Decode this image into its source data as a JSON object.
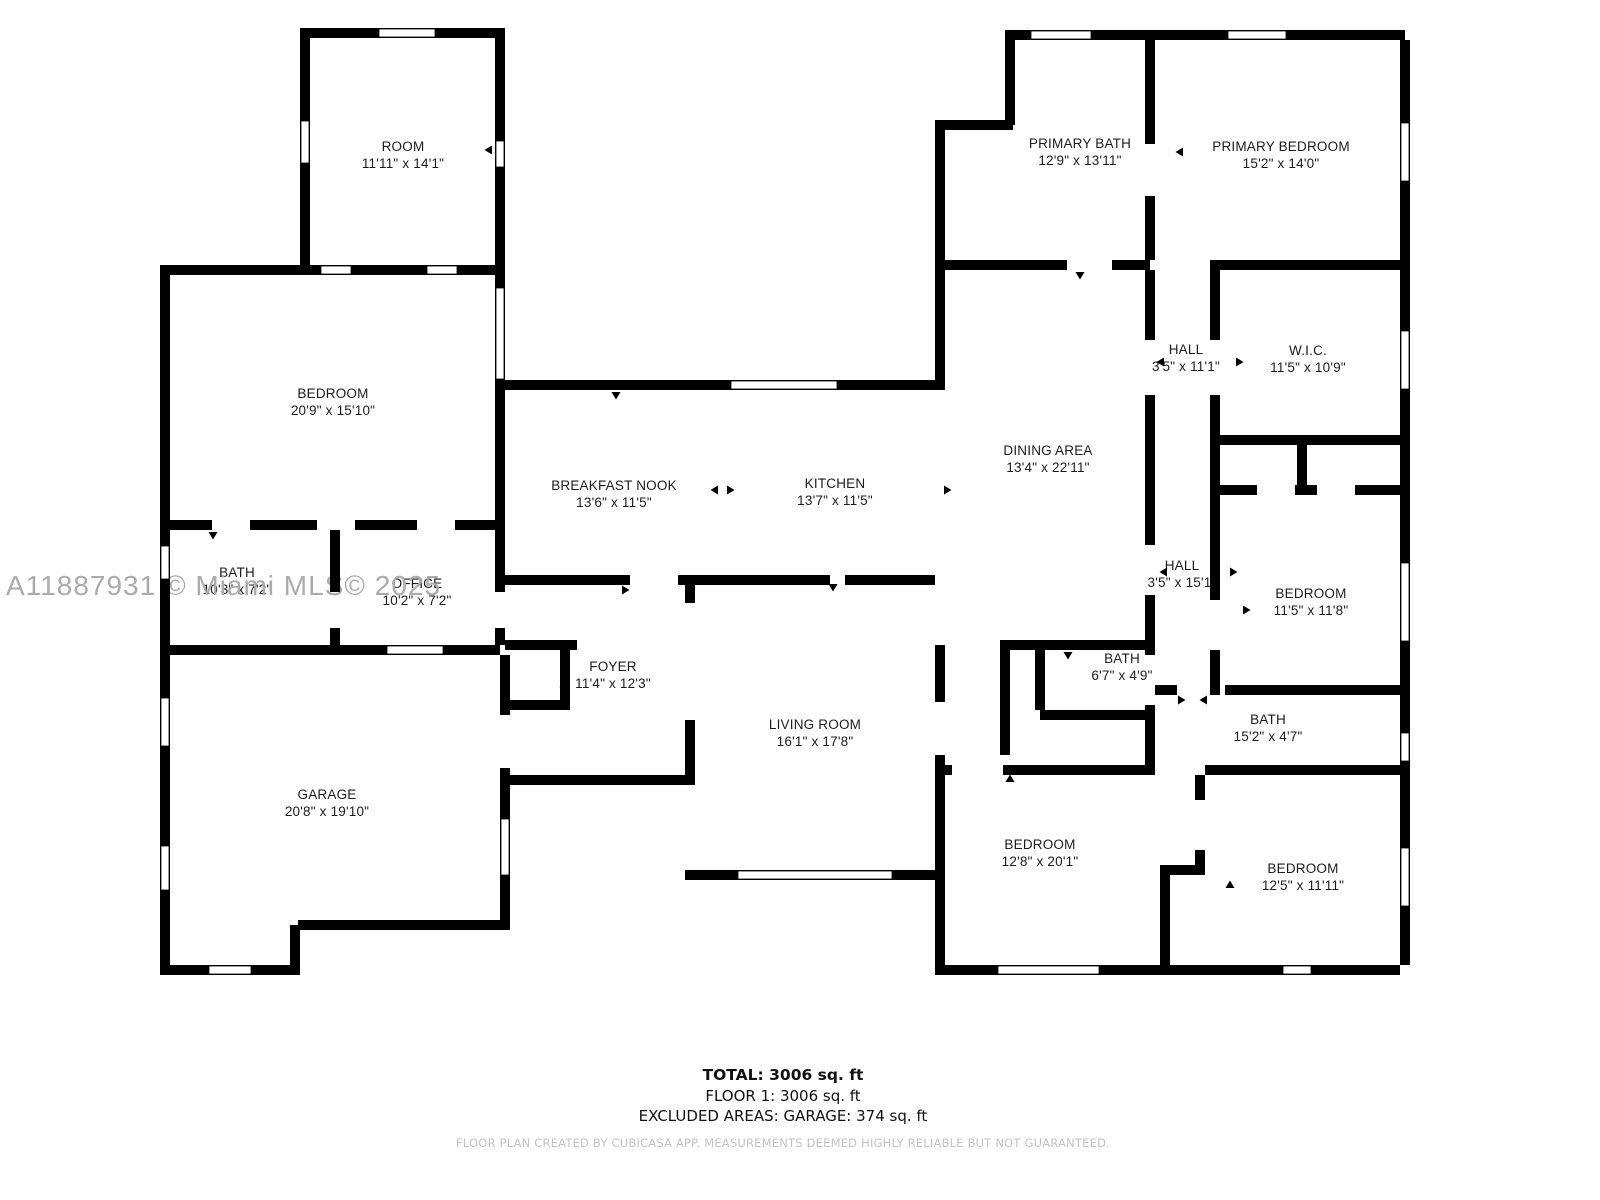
{
  "watermark": "A11887931 © Miami MLS© 2025",
  "rooms": [
    {
      "id": "room",
      "name": "ROOM",
      "dims": "11'11\" x 14'1\"",
      "x": 403,
      "y": 155
    },
    {
      "id": "bedroom-left",
      "name": "BEDROOM",
      "dims": "20'9\" x 15'10\"",
      "x": 333,
      "y": 402
    },
    {
      "id": "bath-left",
      "name": "BATH",
      "dims": "10'3\" x 7'2\"",
      "x": 237,
      "y": 581
    },
    {
      "id": "office",
      "name": "OFFICE",
      "dims": "10'2\" x 7'2\"",
      "x": 417,
      "y": 592
    },
    {
      "id": "garage",
      "name": "GARAGE",
      "dims": "20'8\" x 19'10\"",
      "x": 327,
      "y": 803
    },
    {
      "id": "breakfast-nook",
      "name": "BREAKFAST NOOK",
      "dims": "13'6\" x 11'5\"",
      "x": 614,
      "y": 494
    },
    {
      "id": "kitchen",
      "name": "KITCHEN",
      "dims": "13'7\" x 11'5\"",
      "x": 835,
      "y": 492
    },
    {
      "id": "foyer",
      "name": "FOYER",
      "dims": "11'4\" x 12'3\"",
      "x": 613,
      "y": 675
    },
    {
      "id": "living-room",
      "name": "LIVING ROOM",
      "dims": "16'1\" x 17'8\"",
      "x": 815,
      "y": 733
    },
    {
      "id": "dining-area",
      "name": "DINING AREA",
      "dims": "13'4\" x 22'11\"",
      "x": 1048,
      "y": 459
    },
    {
      "id": "primary-bath",
      "name": "PRIMARY BATH",
      "dims": "12'9\" x 13'11\"",
      "x": 1080,
      "y": 152
    },
    {
      "id": "primary-bedroom",
      "name": "PRIMARY BEDROOM",
      "dims": "15'2\" x 14'0\"",
      "x": 1281,
      "y": 155
    },
    {
      "id": "hall-upper",
      "name": "HALL",
      "dims": "3'5\" x 11'1\"",
      "x": 1186,
      "y": 358
    },
    {
      "id": "wic",
      "name": "W.I.C.",
      "dims": "11'5\" x 10'9\"",
      "x": 1308,
      "y": 359
    },
    {
      "id": "hall-lower",
      "name": "HALL",
      "dims": "3'5\" x 15'1\"",
      "x": 1182,
      "y": 574
    },
    {
      "id": "bedroom-right",
      "name": "BEDROOM",
      "dims": "11'5\" x 11'8\"",
      "x": 1311,
      "y": 602
    },
    {
      "id": "bath-small",
      "name": "BATH",
      "dims": "6'7\" x 4'9\"",
      "x": 1122,
      "y": 667
    },
    {
      "id": "bath-long",
      "name": "BATH",
      "dims": "15'2\" x 4'7\"",
      "x": 1268,
      "y": 728
    },
    {
      "id": "bedroom-bottom-middle",
      "name": "BEDROOM",
      "dims": "12'8\" x 20'1\"",
      "x": 1040,
      "y": 853
    },
    {
      "id": "bedroom-bottom-right",
      "name": "BEDROOM",
      "dims": "12'5\" x 11'11\"",
      "x": 1303,
      "y": 877
    }
  ],
  "summary": {
    "total": "TOTAL: 3006 sq. ft",
    "floor": "FLOOR 1: 3006 sq. ft",
    "excluded": "EXCLUDED AREAS: GARAGE: 374 sq. ft"
  },
  "footer": "FLOOR PLAN CREATED BY CUBICASA APP. MEASUREMENTS DEEMED HIGHLY RELIABLE BUT NOT GUARANTEED.",
  "colors": {
    "wall": "#000000",
    "label": "#1c1c1c",
    "watermark": "#ababab",
    "footer": "#c3c3c3"
  }
}
